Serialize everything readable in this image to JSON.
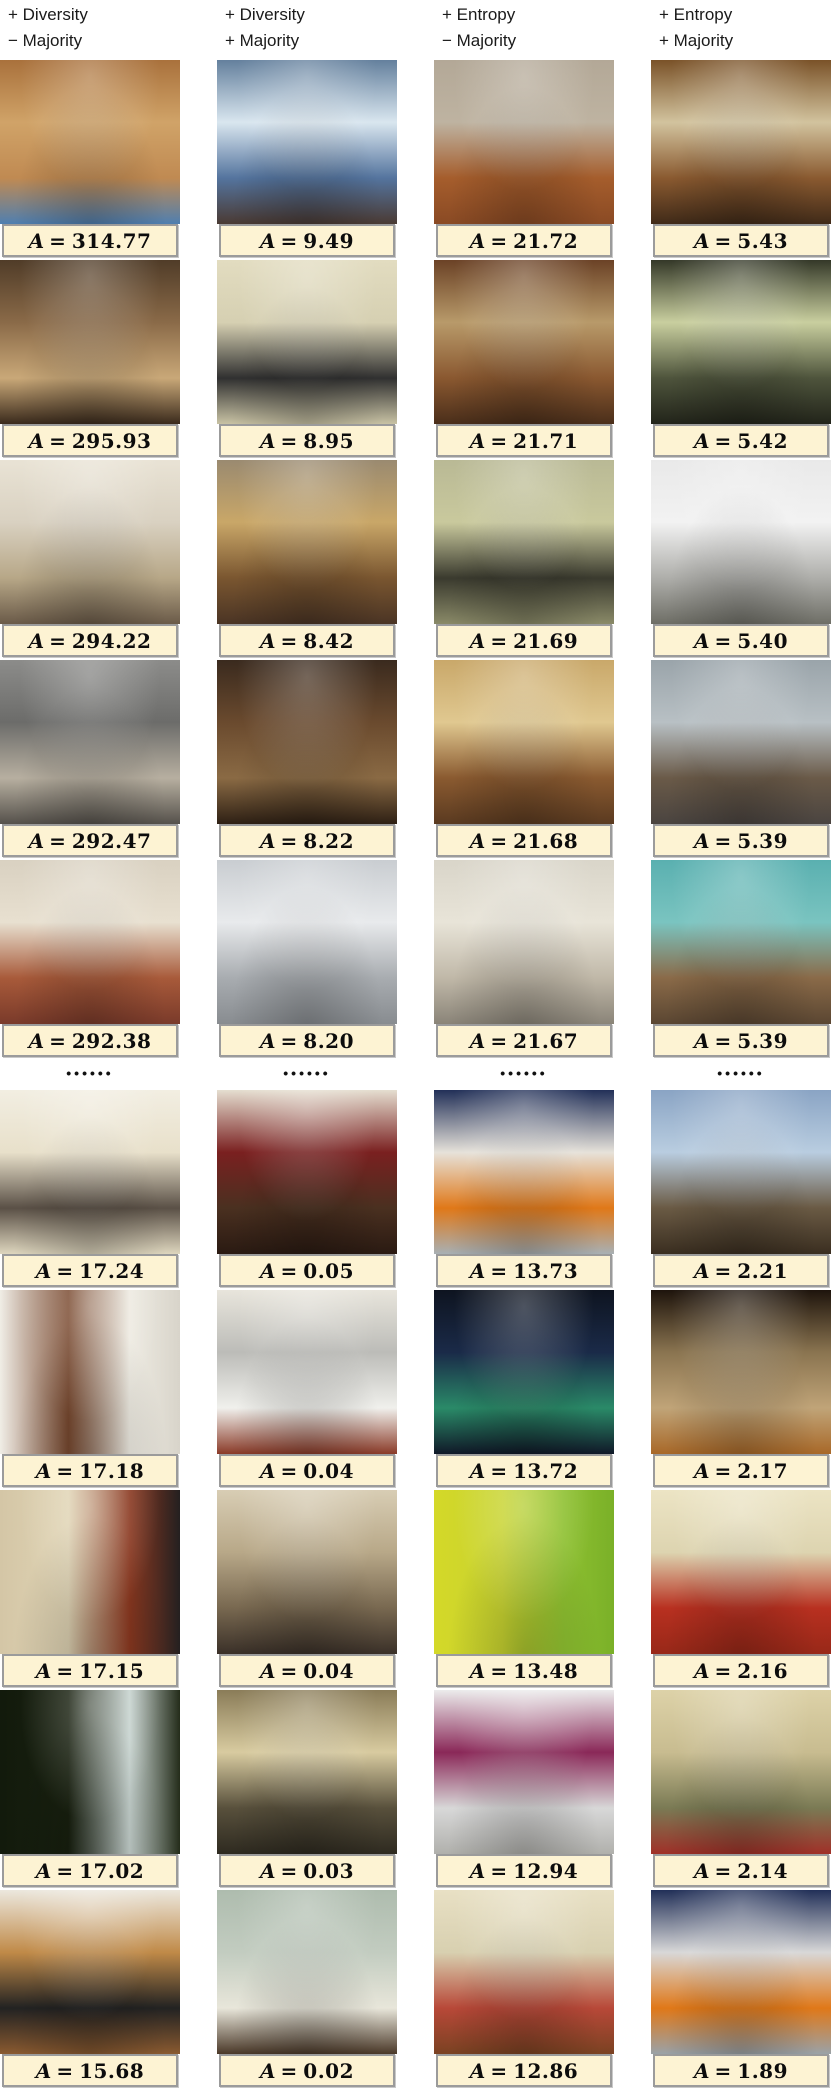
{
  "figure": {
    "symbol": "A",
    "equals": "=",
    "separator_dots": "••••••",
    "label_bg": "#fdf3d3",
    "label_border": "#9b9b9b",
    "columns": [
      {
        "header_line1": "+ Diversity",
        "header_line2": "− Majority"
      },
      {
        "header_line1": "+ Diversity",
        "header_line2": "+ Majority"
      },
      {
        "header_line1": "+ Entropy",
        "header_line2": "− Majority"
      },
      {
        "header_line1": "+ Entropy",
        "header_line2": "+ Majority"
      }
    ],
    "top_rows": [
      {
        "cells": [
          {
            "scene": "wood-beam living room",
            "value": "314.77",
            "dir": "180deg",
            "palette": [
              "#a9713c",
              "#d0a368",
              "#c08a52",
              "#4f7fb0"
            ]
          },
          {
            "scene": "blue traditional living room",
            "value": "9.49",
            "dir": "180deg",
            "palette": [
              "#64809d",
              "#d9e6ef",
              "#54749e",
              "#4a3a33"
            ]
          },
          {
            "scene": "empty room hardwood floor",
            "value": "21.72",
            "dir": "180deg",
            "palette": [
              "#b3a897",
              "#beb3a1",
              "#a55d2c",
              "#8a4a24"
            ]
          },
          {
            "scene": "cherry wood kitchen",
            "value": "5.43",
            "dir": "180deg",
            "palette": [
              "#7a5228",
              "#d2c39e",
              "#8a5a30",
              "#402a18"
            ]
          }
        ]
      },
      {
        "cells": [
          {
            "scene": "lamp-lit living room",
            "value": "295.93",
            "dir": "180deg",
            "palette": [
              "#503c28",
              "#8a6a48",
              "#c9a878",
              "#3a2a1c"
            ]
          },
          {
            "scene": "cream kitchen black oven",
            "value": "8.95",
            "dir": "180deg",
            "palette": [
              "#e2dcc0",
              "#d6d0b2",
              "#303030",
              "#c8c2a4"
            ]
          },
          {
            "scene": "ornate cherry kitchen",
            "value": "21.71",
            "dir": "180deg",
            "palette": [
              "#6b4226",
              "#b89a6a",
              "#8a5830",
              "#4a2e1a"
            ]
          },
          {
            "scene": "dark green kitchen",
            "value": "5.42",
            "dir": "180deg",
            "palette": [
              "#343828",
              "#c9cf9f",
              "#4e543c",
              "#22241a"
            ]
          }
        ]
      },
      {
        "cells": [
          {
            "scene": "beige living room ceiling fan",
            "value": "294.22",
            "dir": "180deg",
            "palette": [
              "#e9e3d5",
              "#d9d1c1",
              "#b7a787",
              "#6a5a48"
            ]
          },
          {
            "scene": "marble island counter",
            "value": "8.42",
            "dir": "180deg",
            "palette": [
              "#9a8a70",
              "#c9a768",
              "#7a5630",
              "#4a3424"
            ]
          },
          {
            "scene": "pale green cabinet kitchen",
            "value": "21.69",
            "dir": "180deg",
            "palette": [
              "#b9b995",
              "#c9c99d",
              "#3a3a2e",
              "#8a8a68"
            ]
          },
          {
            "scene": "white modern kitchen",
            "value": "5.40",
            "dir": "180deg",
            "palette": [
              "#e9e9e9",
              "#f2f2f2",
              "#aeaeaa",
              "#6e6e66"
            ]
          }
        ]
      },
      {
        "cells": [
          {
            "scene": "gray library lounge",
            "value": "292.47",
            "dir": "180deg",
            "palette": [
              "#8c8c8a",
              "#6c6c6a",
              "#b7afa0",
              "#55514b"
            ]
          },
          {
            "scene": "dark wood lounge",
            "value": "8.22",
            "dir": "180deg",
            "palette": [
              "#3a2a1e",
              "#6a4a2e",
              "#8a6a44",
              "#2e2014"
            ]
          },
          {
            "scene": "warm kitchen dining",
            "value": "21.68",
            "dir": "180deg",
            "palette": [
              "#c9a86a",
              "#e0c890",
              "#8a5a30",
              "#5a3a20"
            ]
          },
          {
            "scene": "gray office kitchenette",
            "value": "5.39",
            "dir": "180deg",
            "palette": [
              "#9aa4aa",
              "#b8c0c4",
              "#6a5a48",
              "#4a4440"
            ]
          }
        ]
      },
      {
        "cells": [
          {
            "scene": "fireplace living room rug",
            "value": "292.38",
            "dir": "180deg",
            "palette": [
              "#d9d1c1",
              "#e8e0d0",
              "#a85a3a",
              "#7a3a2a"
            ]
          },
          {
            "scene": "commercial kitchen hood",
            "value": "8.20",
            "dir": "180deg",
            "palette": [
              "#c9cdd1",
              "#e8eaec",
              "#a8acb0",
              "#888c90"
            ]
          },
          {
            "scene": "white kitchen french doors",
            "value": "21.67",
            "dir": "180deg",
            "palette": [
              "#d9d5c9",
              "#e8e4d8",
              "#c0b8a8",
              "#8a8478"
            ]
          },
          {
            "scene": "teal messy utility room",
            "value": "5.39",
            "dir": "180deg",
            "palette": [
              "#5ab0b0",
              "#7ac4c0",
              "#8a6a48",
              "#5a4632"
            ]
          }
        ]
      }
    ],
    "bottom_rows": [
      {
        "cells": [
          {
            "scene": "bright cream dining room",
            "value": "17.24",
            "dir": "180deg",
            "palette": [
              "#f2eee2",
              "#e8e0ca",
              "#5a5046",
              "#ded6be"
            ]
          },
          {
            "scene": "dark living room red curtains",
            "value": "0.05",
            "dir": "180deg",
            "palette": [
              "#e5ded0",
              "#7a2020",
              "#4a3020",
              "#2a1a12"
            ]
          },
          {
            "scene": "office with orange crates",
            "value": "13.73",
            "dir": "180deg",
            "palette": [
              "#223058",
              "#e6e2da",
              "#e07818",
              "#a8b0b4"
            ]
          },
          {
            "scene": "high-rise living room view",
            "value": "2.21",
            "dir": "180deg",
            "palette": [
              "#8aa4c4",
              "#b9cde0",
              "#6a5a44",
              "#3a2e20"
            ]
          }
        ]
      },
      {
        "cells": [
          {
            "scene": "white room wood slat divider",
            "value": "17.18",
            "dir": "90deg",
            "palette": [
              "#f0ede6",
              "#7a4a30",
              "#eeebe2",
              "#d8d4ca"
            ]
          },
          {
            "scene": "kitchen with hanging pots",
            "value": "0.04",
            "dir": "180deg",
            "palette": [
              "#e8e5dc",
              "#bcbcb8",
              "#f0f0ec",
              "#8a3a28"
            ]
          },
          {
            "scene": "dark control room screens",
            "value": "13.72",
            "dir": "180deg",
            "palette": [
              "#0e1420",
              "#1a2a48",
              "#2a8a68",
              "#101828"
            ]
          },
          {
            "scene": "brown couch closeup",
            "value": "2.17",
            "dir": "180deg",
            "palette": [
              "#1e140c",
              "#8a7450",
              "#c0a478",
              "#a86828"
            ]
          }
        ]
      },
      {
        "cells": [
          {
            "scene": "rust-red bar kitchenette",
            "value": "17.15",
            "dir": "90deg",
            "palette": [
              "#d4c6a6",
              "#e0d4b4",
              "#8a3820",
              "#242020"
            ]
          },
          {
            "scene": "sepia cafe tall windows",
            "value": "0.04",
            "dir": "180deg",
            "palette": [
              "#d8cdb4",
              "#b8a888",
              "#786850",
              "#3a3028"
            ]
          },
          {
            "scene": "chartreuse wallpaper sofa",
            "value": "13.48",
            "dir": "90deg",
            "palette": [
              "#d4d828",
              "#c8d430",
              "#8ec030",
              "#7ab028"
            ]
          },
          {
            "scene": "gym office red carpet",
            "value": "2.16",
            "dir": "180deg",
            "palette": [
              "#ece4c4",
              "#ddd4b0",
              "#b83020",
              "#982818"
            ]
          }
        ]
      },
      {
        "cells": [
          {
            "scene": "dark apartment bright window",
            "value": "17.02",
            "dir": "90deg",
            "palette": [
              "#121a0c",
              "#18200f",
              "#c8d4d0",
              "#242c1a"
            ]
          },
          {
            "scene": "bay window sitting room",
            "value": "0.03",
            "dir": "180deg",
            "palette": [
              "#8a7c58",
              "#d8cba0",
              "#58503c",
              "#2e2a20"
            ]
          },
          {
            "scene": "white room magenta trim",
            "value": "12.94",
            "dir": "180deg",
            "palette": [
              "#ececec",
              "#8a2858",
              "#d8d8d8",
              "#b0b0ac"
            ]
          },
          {
            "scene": "olive living room red rug",
            "value": "2.14",
            "dir": "180deg",
            "palette": [
              "#ddd2a8",
              "#c8bc90",
              "#7a7a54",
              "#a03028"
            ]
          }
        ]
      },
      {
        "cells": [
          {
            "scene": "oak kitchen black counter",
            "value": "15.68",
            "dir": "180deg",
            "palette": [
              "#ece8de",
              "#c08a48",
              "#222222",
              "#8a5a30"
            ]
          },
          {
            "scene": "sage room white armchair",
            "value": "0.02",
            "dir": "180deg",
            "palette": [
              "#aebcae",
              "#c2ccc0",
              "#e8e6da",
              "#4a3828"
            ]
          },
          {
            "scene": "victorian living room",
            "value": "12.86",
            "dir": "180deg",
            "palette": [
              "#e8e0c4",
              "#d8d0b0",
              "#b84838",
              "#7a4222"
            ]
          },
          {
            "scene": "office orange crates gray",
            "value": "1.89",
            "dir": "180deg",
            "palette": [
              "#223058",
              "#d8d8d8",
              "#e07818",
              "#9aa2a8"
            ]
          }
        ]
      }
    ]
  }
}
